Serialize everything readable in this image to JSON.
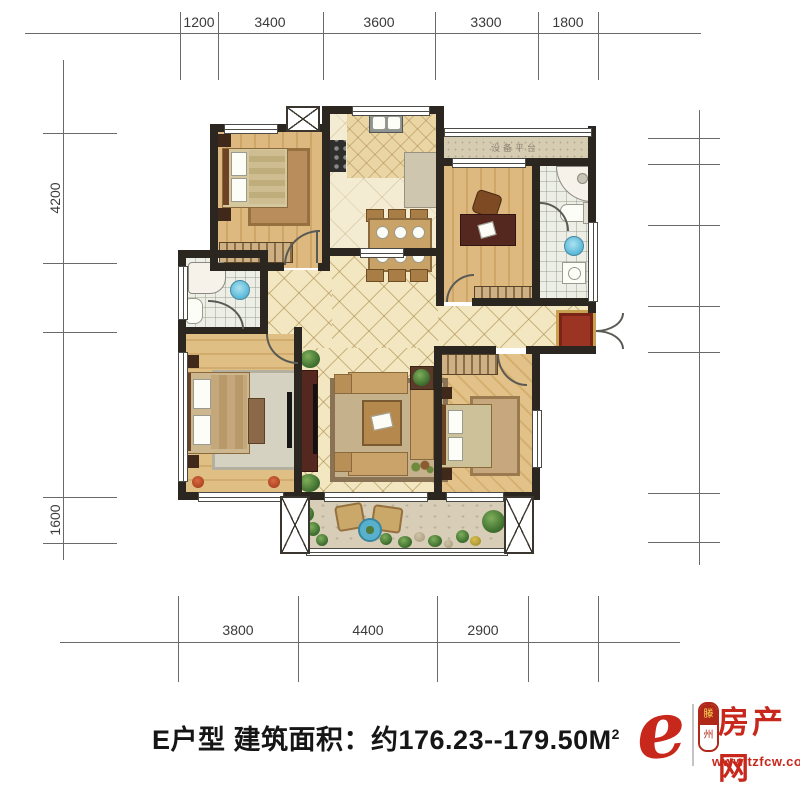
{
  "dimensions": {
    "top": {
      "labels": [
        "1200",
        "3400",
        "3600",
        "3300",
        "1800"
      ]
    },
    "bottom": {
      "labels": [
        "3800",
        "4400",
        "2900"
      ]
    },
    "left": {
      "labels": [
        "4200",
        "1600"
      ]
    }
  },
  "plan": {
    "room_labels": {
      "equipment_platform": "设备平台"
    }
  },
  "caption": {
    "text": "E户型 建筑面积：约176.23--179.50M",
    "superscript": "2"
  },
  "logo": {
    "script_letter": "e",
    "badge_top": "滕",
    "badge_bottom": "州",
    "site_name": "房产网",
    "site_url": "www.tzfcw.com.cn",
    "brand_color": "#c8281c"
  },
  "colors": {
    "wall": "#2b2620",
    "tile_floor": "#f2e7c0",
    "wood_floor": "#ddb97f",
    "entry_rug": "#9c3424",
    "water_blue": "#6cc4dc"
  }
}
